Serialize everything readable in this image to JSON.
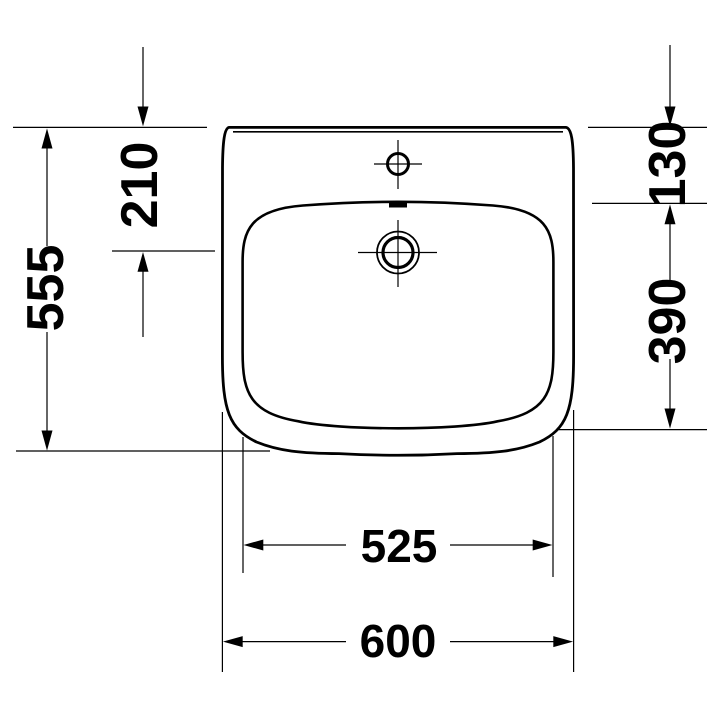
{
  "drawing": {
    "background_color": "#ffffff",
    "line_color": "#000000",
    "dimensions": {
      "left_outer": "555",
      "left_inner": "210",
      "right_top": "130",
      "right_bottom": "390",
      "bottom_inner": "525",
      "bottom_outer": "600"
    }
  }
}
